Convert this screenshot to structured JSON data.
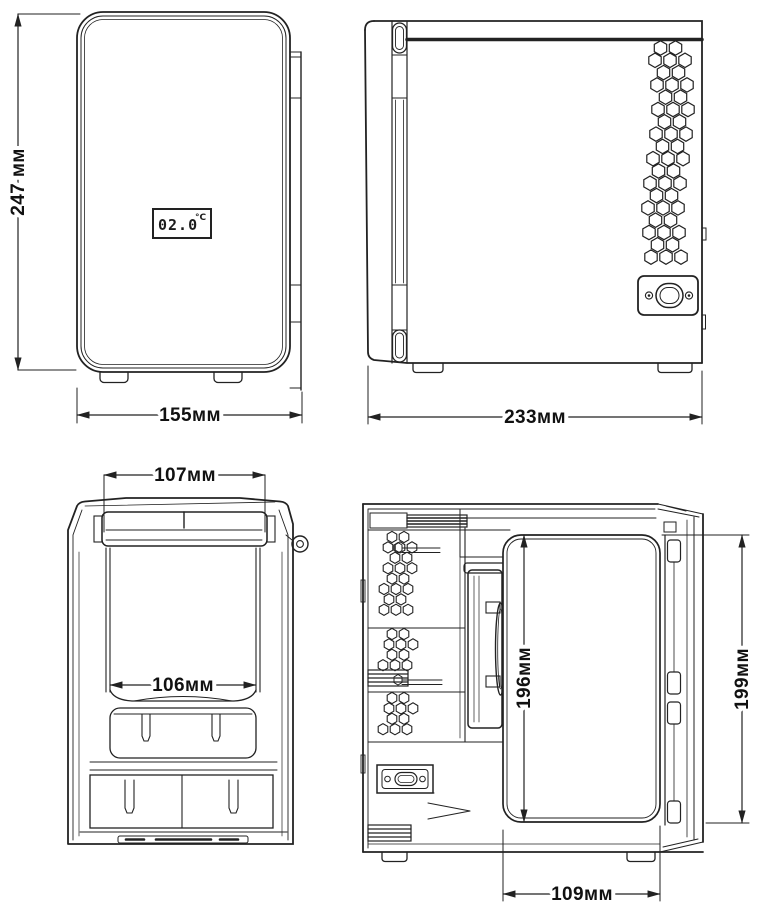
{
  "colors": {
    "background": "#ffffff",
    "line": "#222222",
    "text": "#111111"
  },
  "front_view": {
    "height_dim": "247 мм",
    "width_dim": "155мм",
    "display": {
      "value": "02.0",
      "unit": "°C"
    }
  },
  "side_view": {
    "width_dim": "233мм"
  },
  "front_section": {
    "top_width_dim": "107мм",
    "inner_width_dim": "106мм"
  },
  "side_section": {
    "inner_height_dim": "196мм",
    "outer_height_dim": "199мм",
    "bottom_width_dim": "109мм"
  }
}
